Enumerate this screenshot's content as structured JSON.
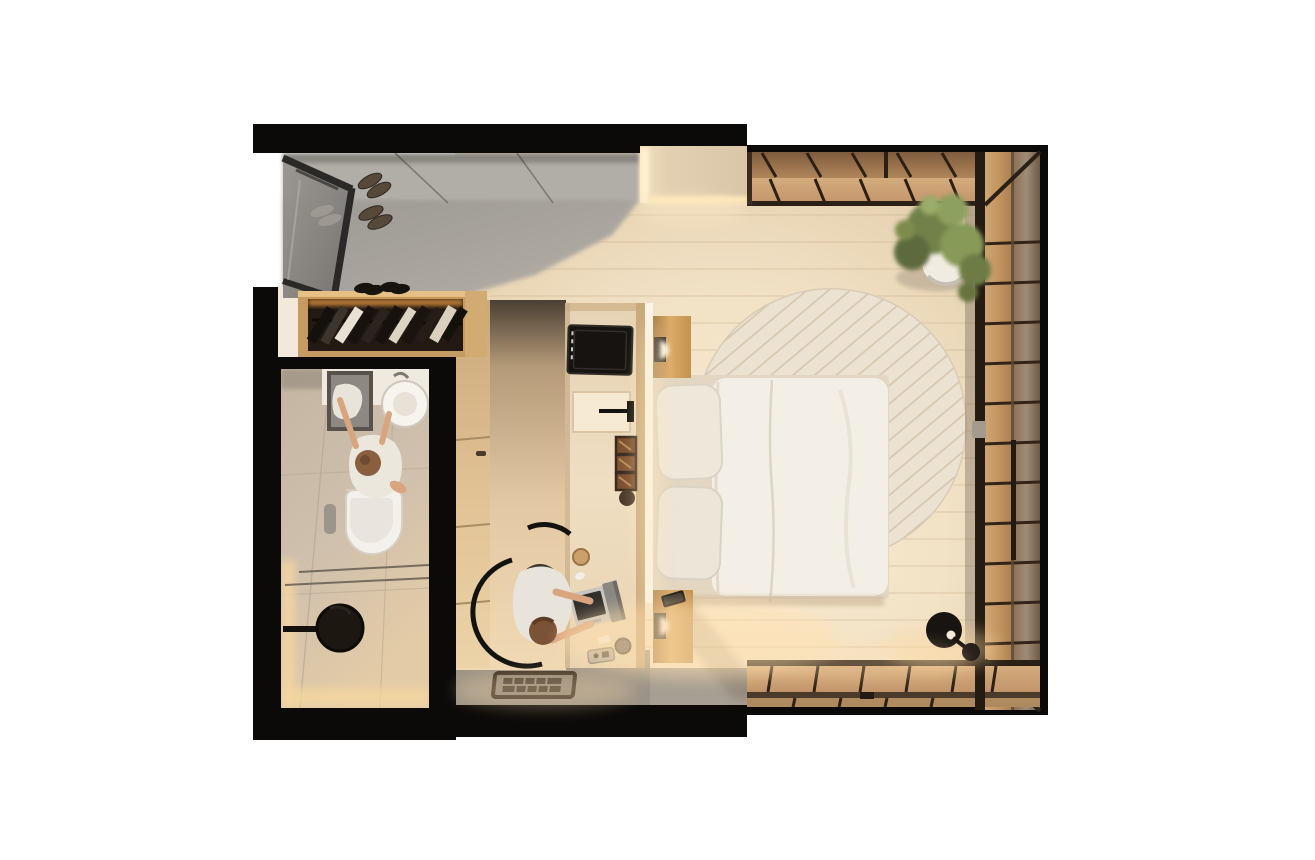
{
  "scene": {
    "title": "Top-down 3D render of a compact studio apartment with bedroom, bathroom and wood-deck balcony",
    "view": "orthographic top-down",
    "background": "#ffffff",
    "rooms": [
      {
        "name": "entry-hall",
        "floor": "polished gray screed",
        "items": [
          "glass partition",
          "three pairs of shoes"
        ]
      },
      {
        "name": "wardrobe-nook",
        "items": [
          "open closet with hanging clothes",
          "clothes rail",
          "shoe pairs on ledge"
        ]
      },
      {
        "name": "bathroom",
        "items": [
          "counter with rectangular sink and towel",
          "round white basin",
          "standing person in towel",
          "wall-hung toilet",
          "flush plate",
          "glass shelves",
          "black round shower head"
        ]
      },
      {
        "name": "bedroom",
        "items": [
          "double bed with white duvet",
          "two stacked pillows",
          "round cream rug with diagonal weave",
          "wooden nightstand top",
          "wooden nightstand bottom with smartphone",
          "two wall sconces",
          "media island with built-in TV",
          "niche with black handle",
          "three display cubbies",
          "desk with open laptop",
          "mug",
          "portable speaker",
          "tray",
          "black chair",
          "person typing on laptop",
          "patterned doormat",
          "black floor lamp"
        ]
      },
      {
        "name": "balcony",
        "items": [
          "wood deck planks top band",
          "wood deck planks right band",
          "wood deck planks bottom band",
          "potted green plant",
          "sliding glass wall with handle"
        ]
      }
    ],
    "people_count": 2,
    "palette": {
      "walls_black": "#0c0a09",
      "bedroom_floor": "#f3e4cb",
      "entry_floor_gray": "#a8a49e",
      "bathroom_floor": "#cfc0ad",
      "island_body": "#ead7ba",
      "wood_warm": "#c79d6e",
      "deck_dark_row": "#96714c",
      "rug_cream": "#ece2d1",
      "duvet_white": "#f4efe6",
      "plant_green": "#7d8c4d",
      "glow_warm": "#ffdfae",
      "glass_gray": "#8e8b86"
    }
  }
}
